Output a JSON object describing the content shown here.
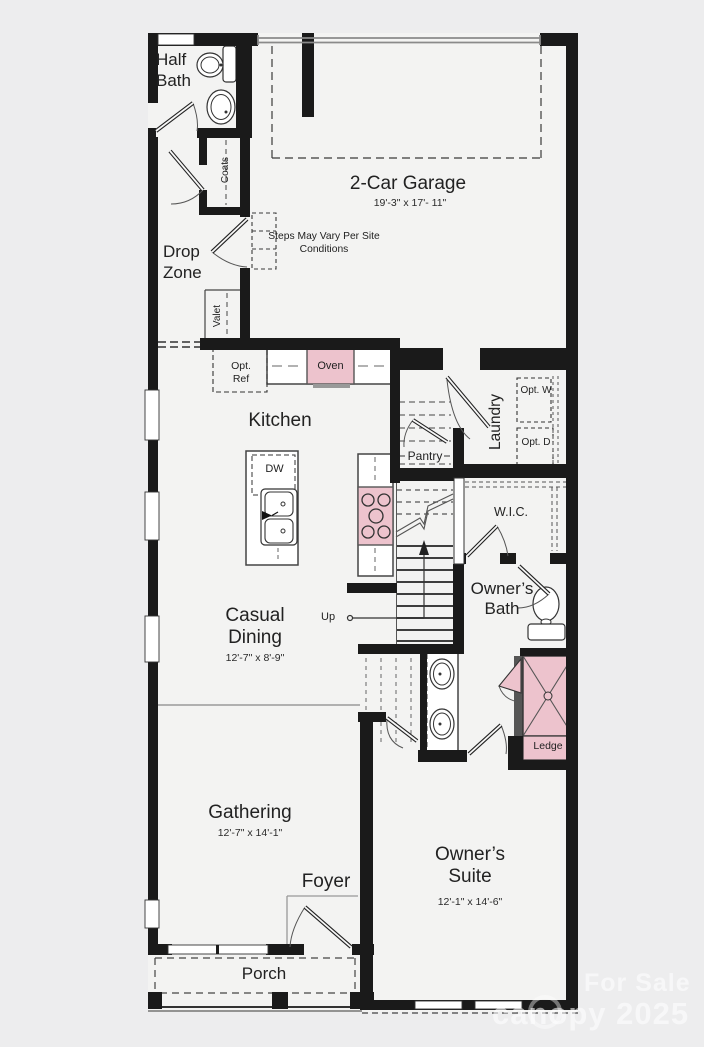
{
  "floorplan": {
    "rooms": {
      "half_bath": {
        "label": "Half Bath"
      },
      "coats": {
        "label": "Coats"
      },
      "drop_zone": {
        "label": "Drop Zone"
      },
      "valet": {
        "label": "Valet"
      },
      "garage": {
        "label": "2-Car Garage",
        "dims": "19'-3\" x 17'- 11\""
      },
      "kitchen": {
        "label": "Kitchen"
      },
      "pantry": {
        "label": "Pantry"
      },
      "laundry": {
        "label": "Laundry"
      },
      "wic": {
        "label": "W.I.C."
      },
      "owners_bath": {
        "label": "Owner’s Bath"
      },
      "casual_dining": {
        "label": "Casual Dining",
        "dims": "12'-7\" x 8'-9\""
      },
      "gathering": {
        "label": "Gathering",
        "dims": "12'-7\" x 14'-1\""
      },
      "foyer": {
        "label": "Foyer"
      },
      "owners_suite": {
        "label": "Owner’s Suite",
        "dims": "12'-1\" x 14'-6\""
      },
      "porch": {
        "label": "Porch"
      }
    },
    "fixtures": {
      "oven": "Oven",
      "dw": "DW",
      "opt_ref": "Opt. Ref",
      "opt_w": "Opt. W",
      "opt_d": "Opt. D",
      "ledge": "Ledge",
      "up": "Up"
    },
    "notes": {
      "steps": "Steps May Vary Per Site Conditions"
    },
    "watermark": {
      "line1": "For Sale",
      "line2": "canopy 2025"
    },
    "colors": {
      "wall": "#1a1a1a",
      "fixture_pink": "#edc3cd",
      "floor": "#f3f3f2",
      "background": "#ededee"
    }
  }
}
